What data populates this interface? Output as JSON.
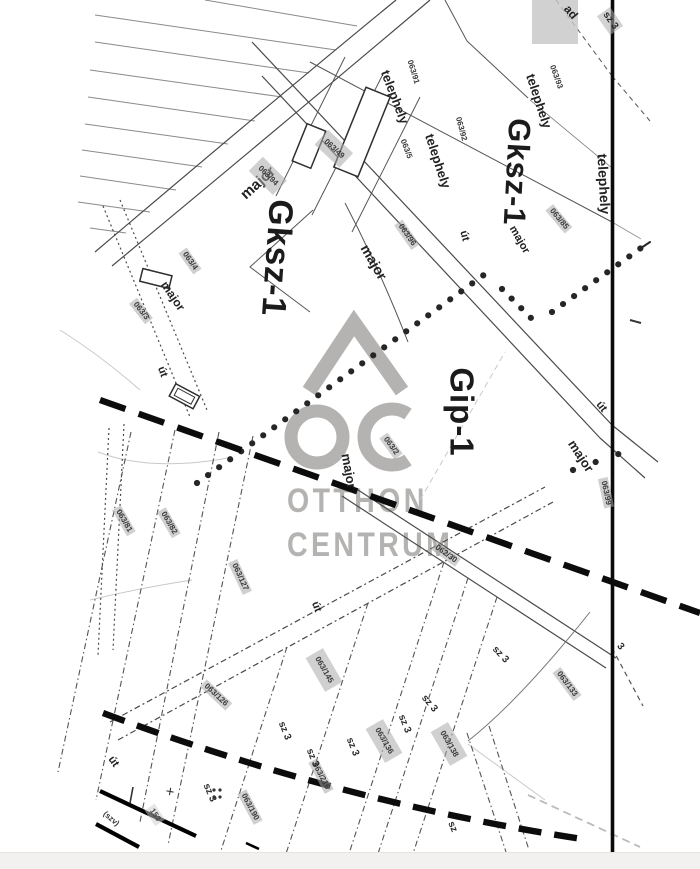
{
  "map_title": "cadastral zoning map scan",
  "watermark": {
    "line1": "OTTHON",
    "line2": "CENTRUM",
    "logo": "oc-house-logo",
    "color": "#b5b3b1"
  },
  "colors": {
    "map_line": "#4a4a4a",
    "boundary_thick": "#0c0c0c",
    "patch": "#b2b2b2",
    "watermark": "#b5b3b1"
  },
  "zones": [
    "Gksz-1",
    "Gksz-1",
    "Gip-1"
  ],
  "labels": [
    {
      "name": "zone-label-gksz1-west",
      "text": "Gksz-1",
      "x": 277,
      "y": 258,
      "r": 94,
      "s": 34,
      "cls": "zone"
    },
    {
      "name": "zone-label-gksz1-east",
      "text": "Gksz-1",
      "x": 517,
      "y": 172,
      "r": 93,
      "s": 31,
      "cls": "zone"
    },
    {
      "name": "zone-label-gip1",
      "text": "Gip-1",
      "x": 462,
      "y": 412,
      "r": 90,
      "s": 33,
      "cls": "zone"
    },
    {
      "name": "major-label-1",
      "text": "major",
      "x": 258,
      "y": 183,
      "r": -42,
      "s": 15,
      "cls": "place"
    },
    {
      "name": "major-label-2",
      "text": "major",
      "x": 374,
      "y": 262,
      "r": 60,
      "s": 14,
      "cls": "place"
    },
    {
      "name": "major-label-3",
      "text": "major",
      "x": 173,
      "y": 296,
      "r": 56,
      "s": 12,
      "cls": "place"
    },
    {
      "name": "major-label-4",
      "text": "major",
      "x": 349,
      "y": 471,
      "r": 80,
      "s": 13,
      "cls": "place"
    },
    {
      "name": "major-label-5",
      "text": "major",
      "x": 581,
      "y": 456,
      "r": 57,
      "s": 13,
      "cls": "place"
    },
    {
      "name": "major-label-6",
      "text": "major",
      "x": 519,
      "y": 240,
      "r": 60,
      "s": 11,
      "cls": "place"
    },
    {
      "name": "telephely-label-1",
      "text": "telephely",
      "x": 395,
      "y": 97,
      "r": 69,
      "s": 13,
      "cls": "place"
    },
    {
      "name": "telephely-label-2",
      "text": "telephely",
      "x": 438,
      "y": 161,
      "r": 72,
      "s": 13,
      "cls": "place"
    },
    {
      "name": "telephely-label-3",
      "text": "telephely",
      "x": 539,
      "y": 101,
      "r": 72,
      "s": 13,
      "cls": "place"
    },
    {
      "name": "telephely-label-4",
      "text": "telephely",
      "x": 604,
      "y": 184,
      "r": 87,
      "s": 14,
      "cls": "place"
    },
    {
      "name": "ut-label-1",
      "text": "út",
      "x": 464,
      "y": 236,
      "r": 75,
      "s": 11,
      "cls": "place"
    },
    {
      "name": "ut-label-2",
      "text": "út",
      "x": 601,
      "y": 407,
      "r": 52,
      "s": 11,
      "cls": "place"
    },
    {
      "name": "ut-label-3",
      "text": "út",
      "x": 162,
      "y": 372,
      "r": 70,
      "s": 11,
      "cls": "place"
    },
    {
      "name": "ut-label-4",
      "text": "út",
      "x": 316,
      "y": 607,
      "r": 70,
      "s": 11,
      "cls": "place"
    },
    {
      "name": "ut-label-5",
      "text": "út",
      "x": 113,
      "y": 762,
      "r": 55,
      "s": 11,
      "cls": "place"
    },
    {
      "name": "road-name-label",
      "text": "ad",
      "x": 571,
      "y": 12,
      "r": 50,
      "s": 12,
      "cls": "place"
    },
    {
      "name": "parcel-063-91",
      "text": "063/91",
      "x": 413,
      "y": 72,
      "r": 73,
      "s": 8,
      "cls": "num-plain"
    },
    {
      "name": "parcel-063-5",
      "text": "063/5",
      "x": 406,
      "y": 149,
      "r": 69,
      "s": 8,
      "cls": "num-plain"
    },
    {
      "name": "parcel-063-92",
      "text": "063/92",
      "x": 461,
      "y": 129,
      "r": 75,
      "s": 8,
      "cls": "num-plain"
    },
    {
      "name": "parcel-063-93",
      "text": "063/93",
      "x": 556,
      "y": 77,
      "r": 70,
      "s": 8,
      "cls": "num-plain"
    },
    {
      "name": "parcel-063-49",
      "text": "063/49",
      "x": 334,
      "y": 149,
      "r": 43,
      "s": 8,
      "cls": "num num-big"
    },
    {
      "name": "parcel-063-94",
      "text": "063/94",
      "x": 268,
      "y": 176,
      "r": 45,
      "s": 8,
      "cls": "num num-big"
    },
    {
      "name": "parcel-063-96",
      "text": "063/96",
      "x": 407,
      "y": 235,
      "r": 55,
      "s": 8,
      "cls": "num"
    },
    {
      "name": "parcel-063-85",
      "text": "063/85",
      "x": 559,
      "y": 219,
      "r": 50,
      "s": 8,
      "cls": "num"
    },
    {
      "name": "parcel-063-4",
      "text": "063/4",
      "x": 190,
      "y": 261,
      "r": 55,
      "s": 8,
      "cls": "num"
    },
    {
      "name": "parcel-063-3",
      "text": "063/3",
      "x": 141,
      "y": 311,
      "r": 52,
      "s": 8,
      "cls": "num"
    },
    {
      "name": "parcel-063-2",
      "text": "063/2",
      "x": 391,
      "y": 446,
      "r": 54,
      "s": 8,
      "cls": "num"
    },
    {
      "name": "parcel-063-99",
      "text": "063/99",
      "x": 606,
      "y": 493,
      "r": 78,
      "s": 8,
      "cls": "num"
    },
    {
      "name": "parcel-062-30",
      "text": "062/30",
      "x": 446,
      "y": 554,
      "r": 36,
      "s": 8,
      "cls": "num"
    },
    {
      "name": "parcel-063-81",
      "text": "063/81",
      "x": 124,
      "y": 521,
      "r": 60,
      "s": 8,
      "cls": "num"
    },
    {
      "name": "parcel-063-82",
      "text": "063/82",
      "x": 169,
      "y": 523,
      "r": 60,
      "s": 8,
      "cls": "num"
    },
    {
      "name": "parcel-063-127",
      "text": "063/127",
      "x": 240,
      "y": 577,
      "r": 65,
      "s": 8,
      "cls": "num"
    },
    {
      "name": "parcel-063-126",
      "text": "063/126",
      "x": 216,
      "y": 695,
      "r": 43,
      "s": 8,
      "cls": "num"
    },
    {
      "name": "parcel-063-145",
      "text": "063/145",
      "x": 324,
      "y": 670,
      "r": 60,
      "s": 8,
      "cls": "num num-big"
    },
    {
      "name": "parcel-063-136",
      "text": "063/136",
      "x": 384,
      "y": 741,
      "r": 60,
      "s": 8,
      "cls": "num num-big"
    },
    {
      "name": "parcel-063-138",
      "text": "063/138",
      "x": 449,
      "y": 744,
      "r": 60,
      "s": 8,
      "cls": "num num-big"
    },
    {
      "name": "parcel-063-133",
      "text": "063/133",
      "x": 567,
      "y": 684,
      "r": 53,
      "s": 8,
      "cls": "num"
    },
    {
      "name": "parcel-063-190",
      "text": "063/190",
      "x": 250,
      "y": 807,
      "r": 62,
      "s": 8,
      "cls": "num"
    },
    {
      "name": "parcel-063-216",
      "text": "063/216",
      "x": 321,
      "y": 776,
      "r": 62,
      "s": 8,
      "cls": "num"
    },
    {
      "name": "marker-153",
      "text": "153",
      "x": 155,
      "y": 815,
      "r": 56,
      "s": 8,
      "cls": "num-light"
    },
    {
      "name": "railway-label-szv",
      "text": "(szv)",
      "x": 111,
      "y": 819,
      "r": 40,
      "s": 8,
      "cls": "num-plain"
    },
    {
      "name": "sz3-label-1",
      "text": "sz 3",
      "x": 610,
      "y": 21,
      "r": 55,
      "s": 10,
      "cls": "sz sz-patch"
    },
    {
      "name": "sz3-label-2",
      "text": "sz 3",
      "x": 500,
      "y": 655,
      "r": 47,
      "s": 10,
      "cls": "sz"
    },
    {
      "name": "sz3-label-3",
      "text": "sz 3",
      "x": 429,
      "y": 704,
      "r": 50,
      "s": 10,
      "cls": "sz"
    },
    {
      "name": "sz3-label-4",
      "text": "sz 3",
      "x": 284,
      "y": 731,
      "r": 68,
      "s": 10,
      "cls": "sz"
    },
    {
      "name": "sz3-label-5",
      "text": "sz 3",
      "x": 352,
      "y": 747,
      "r": 68,
      "s": 10,
      "cls": "sz"
    },
    {
      "name": "sz3-label-6",
      "text": "sz 3",
      "x": 404,
      "y": 724,
      "r": 68,
      "s": 10,
      "cls": "sz"
    },
    {
      "name": "sz3-label-7",
      "text": "sz 3",
      "x": 312,
      "y": 758,
      "r": 68,
      "s": 10,
      "cls": "sz"
    },
    {
      "name": "sz3-label-8",
      "text": "sz 3",
      "x": 209,
      "y": 793,
      "r": 66,
      "s": 10,
      "cls": "sz"
    },
    {
      "name": "sz3-label-9",
      "text": "3",
      "x": 620,
      "y": 647,
      "r": 50,
      "s": 10,
      "cls": "sz"
    },
    {
      "name": "sz-label-10",
      "text": "sz",
      "x": 452,
      "y": 827,
      "r": 68,
      "s": 10,
      "cls": "sz"
    },
    {
      "name": "plus-mark",
      "text": "+",
      "x": 170,
      "y": 792,
      "r": 10,
      "s": 15,
      "cls": "sym"
    }
  ]
}
